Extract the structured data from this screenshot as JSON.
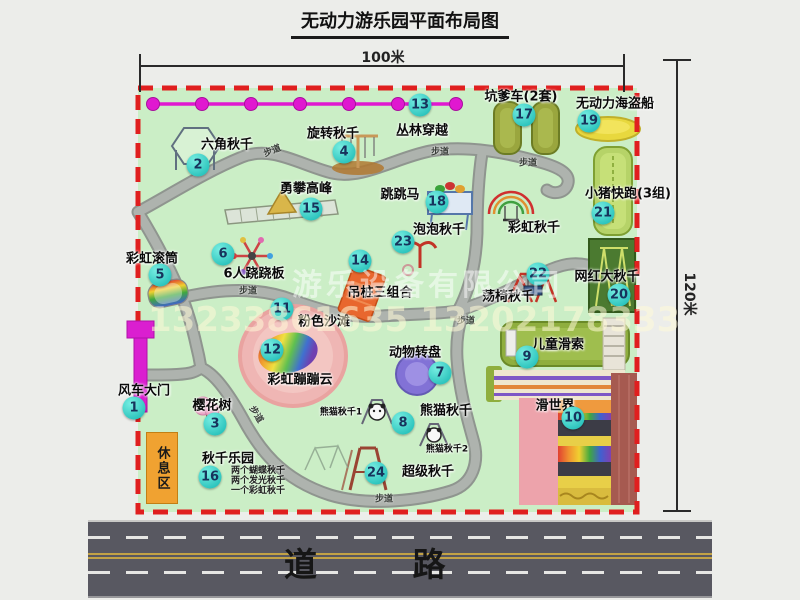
{
  "title": "无动力游乐园平面布局图",
  "dims": {
    "top": "100米",
    "right": "120米"
  },
  "road": {
    "label": "道 路"
  },
  "trail_label": "步道",
  "watermark": {
    "company": "游乐设备有限公司",
    "phone": "13233861635 13202178333"
  },
  "rest_area": {
    "label": "休息区"
  },
  "swing_notes": [
    "两个蝴蝶秋千",
    "两个发光秋千",
    "一个彩虹秋千"
  ],
  "colors": {
    "map_green": "#cbeec6",
    "border_red": "#e01f1f",
    "path_gray": "#aeb3ae",
    "badge_cyan": "#2cc4bd",
    "zipline_magenta": "#e018d0",
    "rest_orange": "#f0a231",
    "road_gray": "#585861"
  },
  "attractions": [
    {
      "n": 1,
      "label": "风车大门",
      "bx": 134,
      "by": 408,
      "lx": 144,
      "ly": 389
    },
    {
      "n": 2,
      "label": "六角秋千",
      "bx": 198,
      "by": 165,
      "lx": 227,
      "ly": 143
    },
    {
      "n": 3,
      "label": "樱花树",
      "bx": 215,
      "by": 424,
      "lx": 212,
      "ly": 404
    },
    {
      "n": 4,
      "label": "旋转秋千",
      "bx": 344,
      "by": 152,
      "lx": 333,
      "ly": 132
    },
    {
      "n": 5,
      "label": "彩虹滚筒",
      "bx": 160,
      "by": 275,
      "lx": 152,
      "ly": 257
    },
    {
      "n": 6,
      "label": "6人跷跷板",
      "bx": 223,
      "by": 254,
      "lx": 254,
      "ly": 272
    },
    {
      "n": 7,
      "label": "动物转盘",
      "bx": 440,
      "by": 373,
      "lx": 415,
      "ly": 351
    },
    {
      "n": 8,
      "label": "熊猫秋千",
      "bx": 403,
      "by": 423,
      "lx": 446,
      "ly": 409
    },
    {
      "n": 9,
      "label": "儿童滑索",
      "bx": 527,
      "by": 357,
      "lx": 558,
      "ly": 343
    },
    {
      "n": 10,
      "label": "滑世界",
      "bx": 573,
      "by": 418,
      "lx": 555,
      "ly": 404
    },
    {
      "n": 11,
      "label": "粉色沙滩",
      "bx": 282,
      "by": 309,
      "lx": 324,
      "ly": 320
    },
    {
      "n": 12,
      "label": "彩虹蹦蹦云",
      "bx": 272,
      "by": 350,
      "lx": 300,
      "ly": 378
    },
    {
      "n": 13,
      "label": "丛林穿越",
      "bx": 420,
      "by": 105,
      "lx": 422,
      "ly": 129
    },
    {
      "n": 14,
      "label": "吊桩三组合",
      "bx": 360,
      "by": 261,
      "lx": 380,
      "ly": 291
    },
    {
      "n": 15,
      "label": "勇攀高峰",
      "bx": 311,
      "by": 209,
      "lx": 306,
      "ly": 187
    },
    {
      "n": 16,
      "label": "秋千乐园",
      "bx": 210,
      "by": 477,
      "lx": 228,
      "ly": 457
    },
    {
      "n": 17,
      "label": "坑爹车(2套)",
      "bx": 524,
      "by": 115,
      "lx": 521,
      "ly": 95
    },
    {
      "n": 18,
      "label": "跳跳马",
      "bx": 437,
      "by": 202,
      "lx": 400,
      "ly": 193
    },
    {
      "n": 19,
      "label": "无动力海盗船",
      "bx": 589,
      "by": 121,
      "lx": 615,
      "ly": 102
    },
    {
      "n": 20,
      "label": "网红大秋千",
      "bx": 619,
      "by": 295,
      "lx": 607,
      "ly": 275
    },
    {
      "n": 21,
      "label": "小猪快跑(3组)",
      "bx": 603,
      "by": 213,
      "lx": 628,
      "ly": 192
    },
    {
      "n": 22,
      "label": "荡椅秋千",
      "bx": 538,
      "by": 274,
      "lx": 508,
      "ly": 295
    },
    {
      "n": 23,
      "label": "泡泡秋千",
      "bx": 403,
      "by": 242,
      "lx": 439,
      "ly": 228
    },
    {
      "n": 24,
      "label": "超级秋千",
      "bx": 376,
      "by": 473,
      "lx": 428,
      "ly": 470
    }
  ],
  "extra_labels": [
    {
      "text": "彩虹秋千",
      "x": 534,
      "y": 226,
      "size": 13
    },
    {
      "text": "熊猫秋千1",
      "x": 341,
      "y": 411,
      "size": 9
    },
    {
      "text": "熊猫秋千2",
      "x": 447,
      "y": 448,
      "size": 9
    }
  ],
  "trail_markers": [
    {
      "x": 272,
      "y": 150,
      "r": -22
    },
    {
      "x": 440,
      "y": 151,
      "r": 0
    },
    {
      "x": 528,
      "y": 162,
      "r": 0
    },
    {
      "x": 248,
      "y": 290,
      "r": 0
    },
    {
      "x": 257,
      "y": 414,
      "r": 58
    },
    {
      "x": 384,
      "y": 498,
      "r": 0
    },
    {
      "x": 466,
      "y": 320,
      "r": 0
    }
  ]
}
